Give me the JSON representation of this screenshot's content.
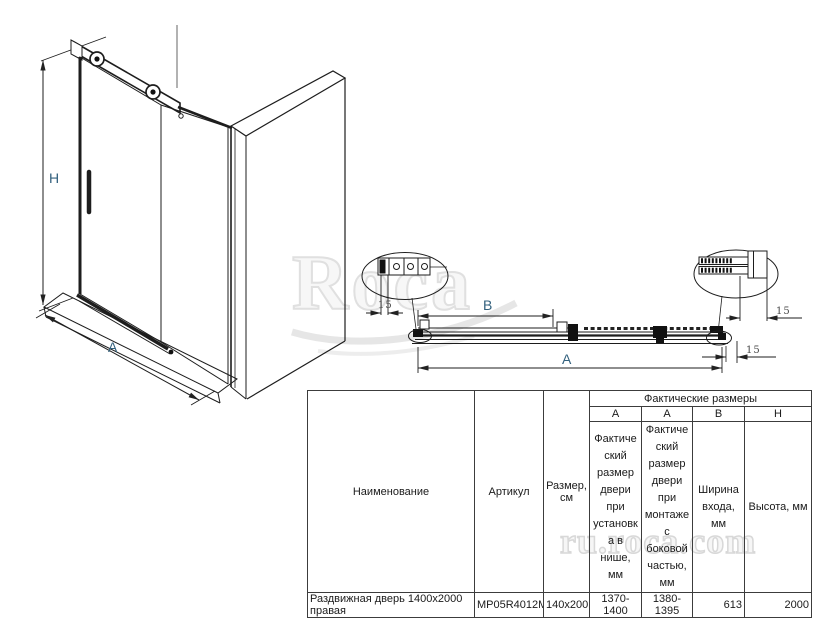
{
  "watermark": {
    "brand": "Roca",
    "site": "ru.roca.com"
  },
  "iso_view": {
    "h_label": "H",
    "a_label": "A"
  },
  "plan_view": {
    "b_label": "B",
    "a_label": "A",
    "dim_left": "15",
    "dim_right_top": "15",
    "dim_right_bottom": "15"
  },
  "table": {
    "col_name": "Наименование",
    "col_article": "Артикул",
    "col_size": "Размер, см",
    "group_header": "Фактические размеры",
    "sub_cols": [
      "A",
      "A",
      "B",
      "H"
    ],
    "desc_a1": "Фактический размер двери при установка в нише, мм",
    "desc_a2": "Фактический размер двери при монтаже с боковой частью, мм",
    "desc_b": "Ширина входа, мм",
    "desc_h": "Высота, мм",
    "rows": [
      {
        "name": "Раздвижная дверь 1400х2000 правая",
        "article": "MP05R4012M",
        "size": "140x200",
        "a1": "1370-1400",
        "a2": "1380-1395",
        "b": "613",
        "h": "2000"
      }
    ]
  }
}
